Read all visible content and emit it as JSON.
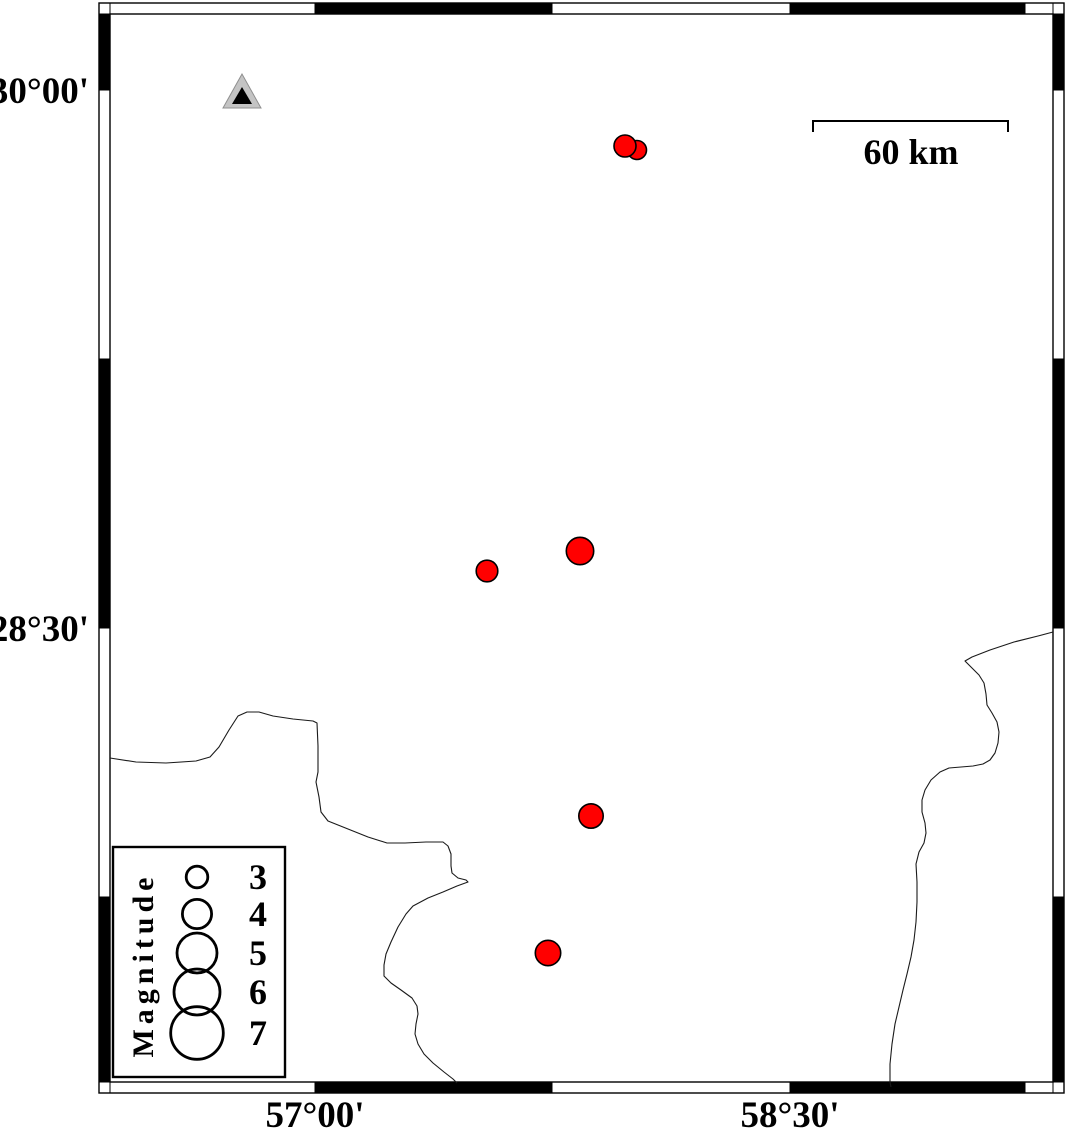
{
  "axes": {
    "lat_labels": [
      {
        "text": "30°00'",
        "y": 90
      },
      {
        "text": "28°30'",
        "y": 628
      }
    ],
    "lon_labels": [
      {
        "text": "57°00'",
        "x": 315
      },
      {
        "text": "58°30'",
        "x": 790
      }
    ]
  },
  "frame": {
    "outer": [
      99,
      3,
      1064,
      1093
    ],
    "inner": [
      110,
      14,
      1053,
      1082
    ],
    "x_bounds": [
      110,
      315,
      552,
      790,
      1025,
      1053
    ],
    "y_bounds": [
      14,
      90,
      359,
      628,
      897,
      1082
    ],
    "x_black": [
      [
        315,
        552
      ],
      [
        790,
        1025
      ]
    ],
    "y_black": [
      [
        14,
        90
      ],
      [
        359,
        628
      ],
      [
        897,
        1082
      ]
    ]
  },
  "scale_bar": {
    "label": "60 km",
    "x1": 813,
    "x2": 1008,
    "y": 121,
    "tick_drop": 11
  },
  "station": {
    "outer_points": "242,74 223,108 261,108",
    "inner_points": "242,87 232,104 252,104",
    "outer_color": "#c4c4c4",
    "inner_color": "#000000"
  },
  "earthquakes": [
    {
      "cx": 637,
      "cy": 150,
      "r": 9.5
    },
    {
      "cx": 625,
      "cy": 146,
      "r": 11
    },
    {
      "cx": 580,
      "cy": 551,
      "r": 13.7
    },
    {
      "cx": 487,
      "cy": 571,
      "r": 10.8
    },
    {
      "cx": 591,
      "cy": 816,
      "r": 12.2
    },
    {
      "cx": 548,
      "cy": 953,
      "r": 12.7
    }
  ],
  "boundaries": {
    "west": [
      [
        110,
        758
      ],
      [
        136,
        762
      ],
      [
        166,
        763
      ],
      [
        196,
        761
      ],
      [
        210,
        757
      ],
      [
        219,
        747
      ],
      [
        229,
        730
      ],
      [
        238,
        716
      ],
      [
        247,
        712
      ],
      [
        259,
        712
      ],
      [
        273,
        716
      ],
      [
        293,
        719
      ],
      [
        313,
        721
      ],
      [
        317,
        723
      ],
      [
        318,
        746
      ],
      [
        318,
        772
      ],
      [
        316,
        782
      ],
      [
        319,
        797
      ],
      [
        321,
        812
      ],
      [
        328,
        821
      ],
      [
        348,
        829
      ],
      [
        368,
        837
      ],
      [
        387,
        843
      ],
      [
        405,
        843
      ],
      [
        426,
        842
      ],
      [
        443,
        842
      ],
      [
        448,
        846
      ],
      [
        451,
        854
      ],
      [
        451,
        866
      ],
      [
        452,
        873
      ],
      [
        458,
        878
      ],
      [
        466,
        880
      ],
      [
        468,
        882
      ],
      [
        457,
        886
      ],
      [
        443,
        892
      ],
      [
        428,
        898
      ],
      [
        413,
        906
      ],
      [
        406,
        914
      ],
      [
        398,
        927
      ],
      [
        391,
        942
      ],
      [
        386,
        954
      ],
      [
        384,
        965
      ],
      [
        384,
        976
      ],
      [
        391,
        983
      ],
      [
        401,
        990
      ],
      [
        412,
        998
      ],
      [
        417,
        1006
      ],
      [
        418,
        1014
      ],
      [
        416,
        1024
      ],
      [
        415,
        1034
      ],
      [
        418,
        1044
      ],
      [
        424,
        1054
      ],
      [
        433,
        1063
      ],
      [
        444,
        1072
      ],
      [
        453,
        1079
      ],
      [
        457,
        1083
      ]
    ],
    "east": [
      [
        1053,
        632
      ],
      [
        1038,
        636
      ],
      [
        1014,
        642
      ],
      [
        990,
        650
      ],
      [
        972,
        657
      ],
      [
        965,
        661
      ],
      [
        971,
        667
      ],
      [
        979,
        675
      ],
      [
        984,
        683
      ],
      [
        986,
        694
      ],
      [
        987,
        705
      ],
      [
        992,
        713
      ],
      [
        997,
        722
      ],
      [
        999,
        732
      ],
      [
        998,
        743
      ],
      [
        995,
        753
      ],
      [
        990,
        760
      ],
      [
        983,
        764
      ],
      [
        973,
        766
      ],
      [
        961,
        767
      ],
      [
        949,
        768
      ],
      [
        940,
        772
      ],
      [
        931,
        780
      ],
      [
        925,
        790
      ],
      [
        922,
        800
      ],
      [
        922,
        812
      ],
      [
        925,
        823
      ],
      [
        926,
        833
      ],
      [
        924,
        843
      ],
      [
        919,
        852
      ],
      [
        916,
        864
      ],
      [
        917,
        882
      ],
      [
        917,
        902
      ],
      [
        916,
        922
      ],
      [
        914,
        940
      ],
      [
        911,
        957
      ],
      [
        907,
        974
      ],
      [
        903,
        990
      ],
      [
        899,
        1007
      ],
      [
        895,
        1024
      ],
      [
        892,
        1044
      ],
      [
        890,
        1064
      ],
      [
        890,
        1082
      ],
      [
        891,
        1087
      ]
    ]
  },
  "legend": {
    "title": "Magnitude",
    "box": [
      113,
      847,
      285,
      1077
    ],
    "circle_cx": 197,
    "label_x": 258,
    "entries": [
      {
        "label": "3",
        "cy": 877,
        "r": 10.8
      },
      {
        "label": "4",
        "cy": 914,
        "r": 14.6
      },
      {
        "label": "5",
        "cy": 953,
        "r": 20
      },
      {
        "label": "6",
        "cy": 992,
        "r": 23
      },
      {
        "label": "7",
        "cy": 1033,
        "r": 26.3
      }
    ]
  },
  "colors": {
    "epicenter_fill": "#ff0000",
    "epicenter_stroke": "#000000",
    "frame_black": "#000000",
    "boundary_line": "#1a1a1a",
    "background": "#ffffff"
  }
}
